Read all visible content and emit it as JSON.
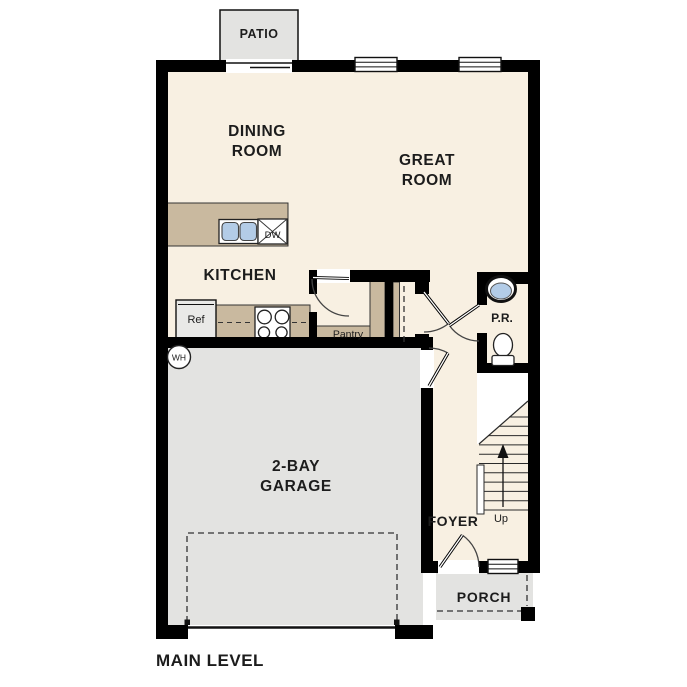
{
  "title": "MAIN LEVEL",
  "colors": {
    "wall": "#000000",
    "floor": "#f8f0e2",
    "concrete_gray": "#e3e3e1",
    "counter_tan": "#c9b99f",
    "sink_blue": "#b3cce7"
  },
  "rooms": {
    "patio": "PATIO",
    "dining_room": {
      "line1": "DINING",
      "line2": "ROOM"
    },
    "great_room": {
      "line1": "GREAT",
      "line2": "ROOM"
    },
    "kitchen": "KITCHEN",
    "pantry": "Pantry",
    "powder_room": "P.R.",
    "garage": {
      "line1": "2-BAY",
      "line2": "GARAGE"
    },
    "foyer": "FOYER",
    "porch": "PORCH"
  },
  "fixtures": {
    "refrigerator": "Ref",
    "dishwasher": "DW",
    "water_heater": "WH",
    "stairs_direction": "Up"
  }
}
